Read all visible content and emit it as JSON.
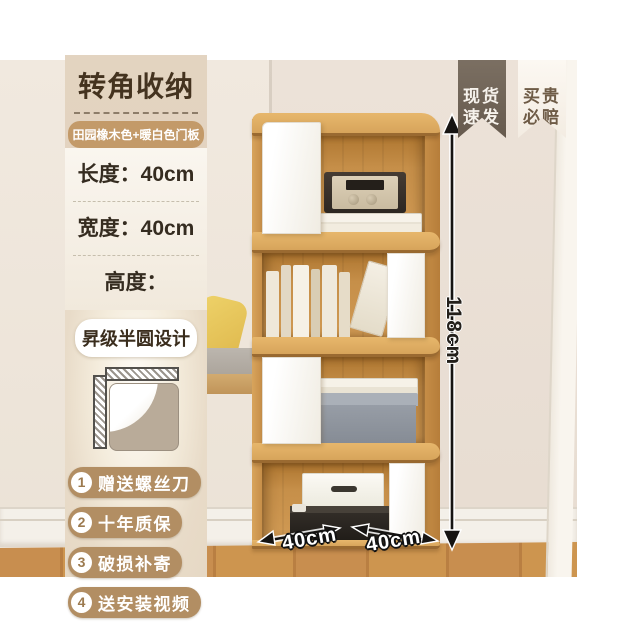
{
  "panel": {
    "title": "转角收纳",
    "color_badge": "田园橡木色+暖白色门板",
    "specs": [
      {
        "label": "长度：",
        "value": "40cm"
      },
      {
        "label": "宽度：",
        "value": "40cm"
      },
      {
        "label": "高度：",
        "value": "118cm"
      }
    ],
    "design_badge": "昇级半圆设计",
    "features": [
      {
        "num": "1",
        "text": "赠送螺丝刀"
      },
      {
        "num": "2",
        "text": "十年质保"
      },
      {
        "num": "3",
        "text": "破损补寄"
      },
      {
        "num": "4",
        "text": "送安装视频"
      }
    ]
  },
  "ribbons": [
    {
      "line1": "现货",
      "line2": "速发"
    },
    {
      "line1": "买贵",
      "line2": "必赔"
    }
  ],
  "dimensions": {
    "height_label": "118cm",
    "width_left_label": "40cm",
    "width_right_label": "40cm"
  },
  "colors": {
    "accent_tan": "#c39a69",
    "dark_brown": "#44331f",
    "ribbon_dark": "#6f6357",
    "wood": "#cf9a55",
    "wall": "#ece3d8",
    "panel_beige": "#e2d2be"
  }
}
